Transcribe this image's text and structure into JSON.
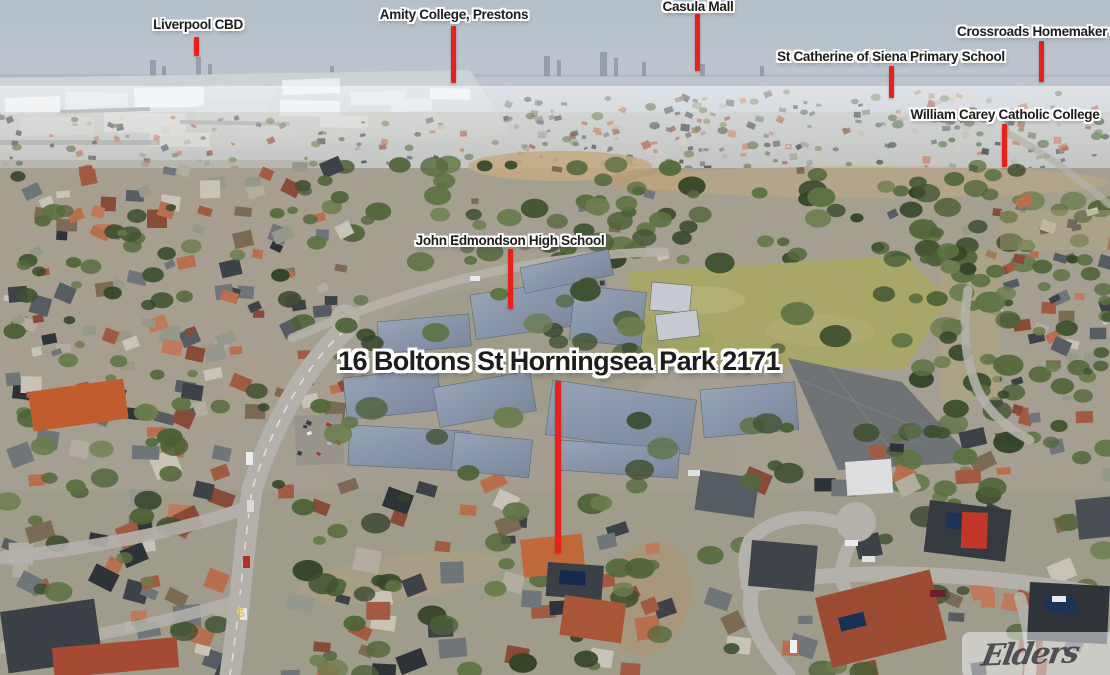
{
  "property_title": "16 Boltons St Horningsea Park 2171",
  "watermark_text": "Elders",
  "road_marking": "40",
  "colors": {
    "pointer_red": "#e8211a",
    "label_text": "#1d1d1b",
    "label_outline": "#ffffff",
    "sky_haze": "#bfc8d0",
    "school_roof_blue": "#8794a9",
    "sports_field_green": "#a9a767",
    "court_gray": "#6f7375"
  },
  "landmarks": [
    {
      "id": "liverpool-cbd",
      "label": "Liverpool CBD"
    },
    {
      "id": "amity-college-prestons",
      "label": "Amity College, Prestons"
    },
    {
      "id": "casula-mall",
      "label": "Casula Mall"
    },
    {
      "id": "st-catherine-of-siena-primary-school",
      "label": "St Catherine of Siena Primary School"
    },
    {
      "id": "crossroads-homemaker-centre",
      "label": "Crossroads Homemaker Cen"
    },
    {
      "id": "william-carey-catholic-college",
      "label": "William Carey Catholic College"
    },
    {
      "id": "john-edmondson-high-school",
      "label": "John Edmondson High School"
    }
  ]
}
